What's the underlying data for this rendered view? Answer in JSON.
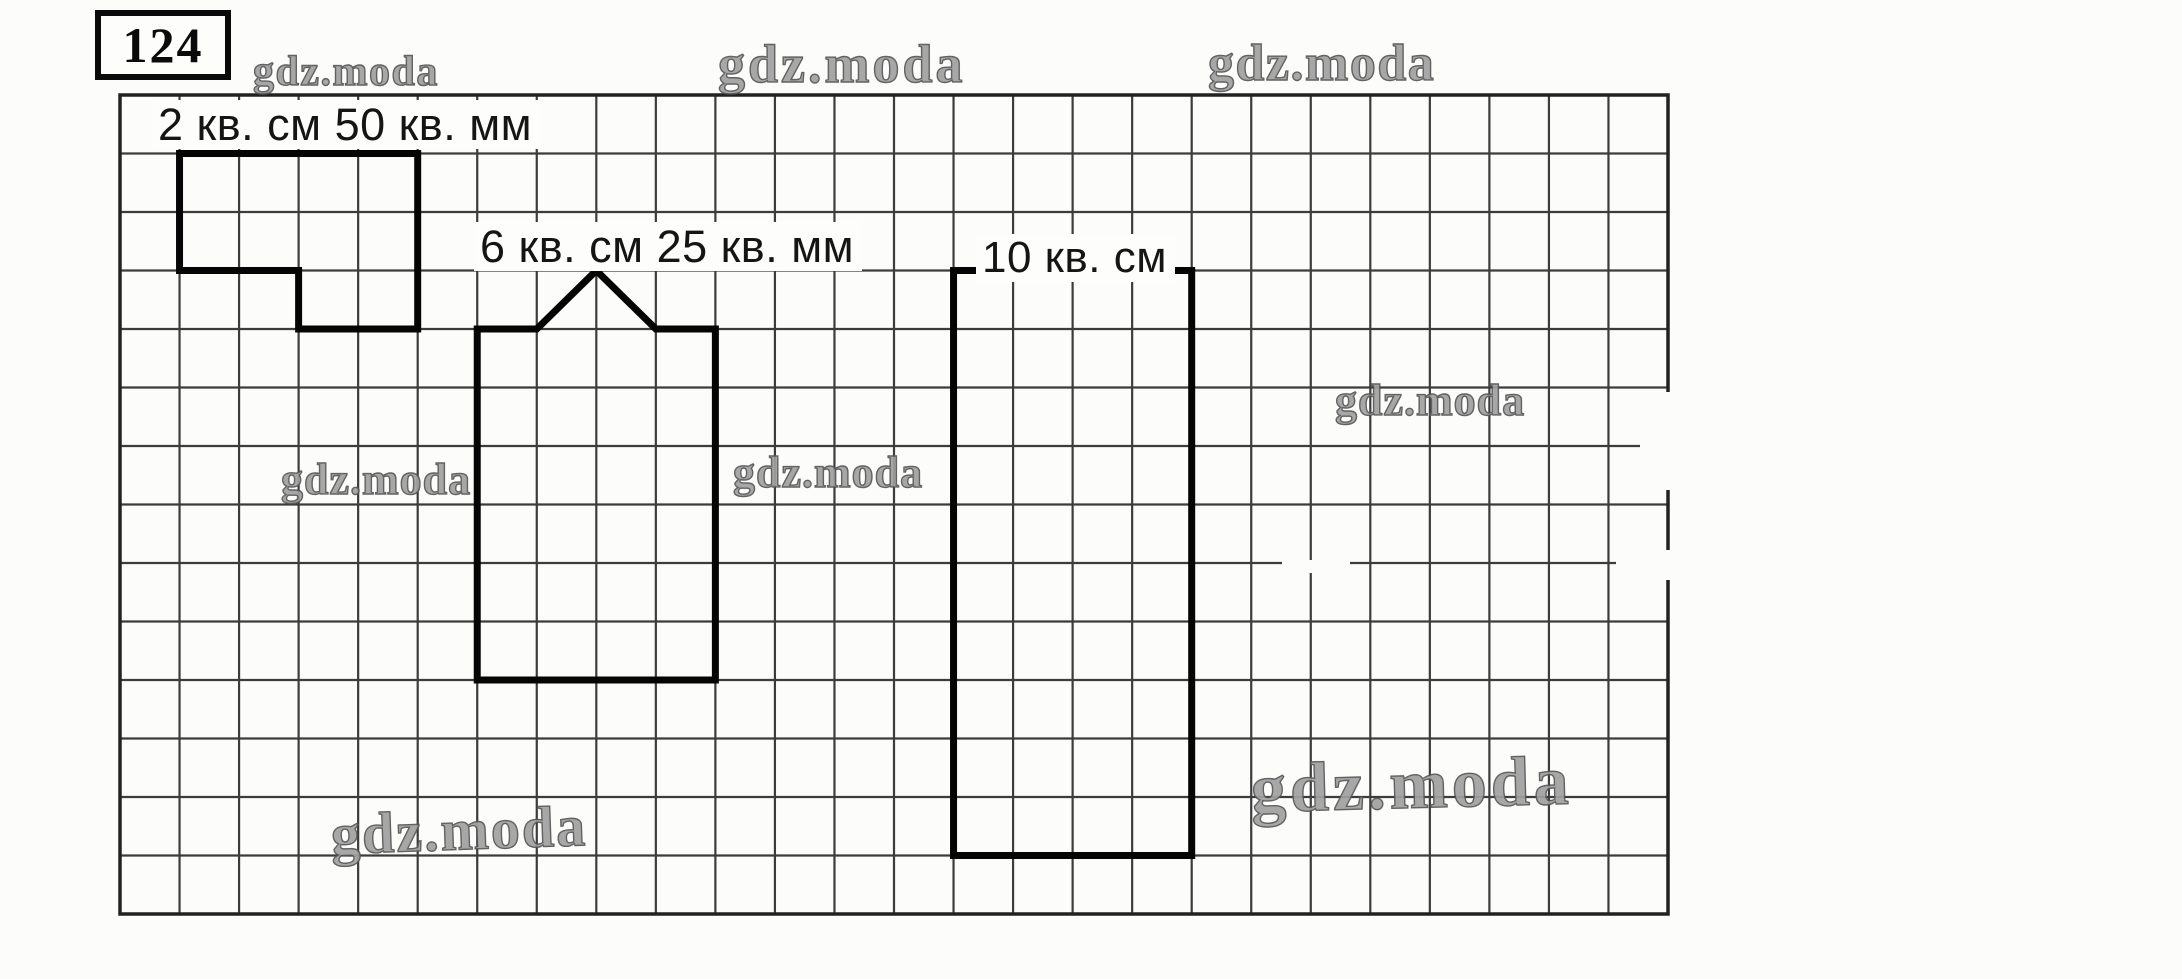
{
  "problem_number": "124",
  "watermark_text": "gdz.moda",
  "paper_color": "#fcfcfa",
  "grid": {
    "left": 120,
    "top": 95,
    "width": 1548,
    "height": 819,
    "cols": 26,
    "rows": 14,
    "line_color": "#3c3c3c",
    "border_color": "#222222",
    "line_width": 2.2,
    "border_width": 3.5
  },
  "shape_stroke": {
    "color": "#050505",
    "width": 7
  },
  "shapes": [
    {
      "name": "step-figure",
      "area_label": "2 кв. см 50 кв. мм",
      "label_pos": {
        "x": 152,
        "y": 100
      },
      "label_font_size": 45,
      "vertices_cells": [
        [
          1,
          1
        ],
        [
          5,
          1
        ],
        [
          5,
          4
        ],
        [
          3,
          4
        ],
        [
          3,
          3
        ],
        [
          1,
          3
        ]
      ]
    },
    {
      "name": "pentagon-house-figure",
      "area_label": "6 кв. см 25 кв. мм",
      "label_pos": {
        "x": 474,
        "y": 222
      },
      "label_font_size": 45,
      "vertices_cells": [
        [
          6,
          4
        ],
        [
          7,
          4
        ],
        [
          8,
          3
        ],
        [
          9,
          4
        ],
        [
          10,
          4
        ],
        [
          10,
          10
        ],
        [
          6,
          10
        ]
      ]
    },
    {
      "name": "tall-rectangle-figure",
      "area_label": "10 кв. см",
      "label_pos": {
        "x": 976,
        "y": 234
      },
      "label_font_size": 44,
      "vertices_cells": [
        [
          14,
          3
        ],
        [
          18,
          3
        ],
        [
          18,
          13
        ],
        [
          14,
          13
        ]
      ]
    }
  ],
  "watermarks": [
    {
      "x": 253,
      "y": 51,
      "font_size": 42,
      "letter_spacing": 1.5,
      "rotate": 0
    },
    {
      "x": 718,
      "y": 37,
      "font_size": 54,
      "letter_spacing": 3,
      "rotate": 0
    },
    {
      "x": 1208,
      "y": 38,
      "font_size": 52,
      "letter_spacing": 1.5,
      "rotate": 0
    },
    {
      "x": 1335,
      "y": 379,
      "font_size": 44,
      "letter_spacing": 1,
      "rotate": 0
    },
    {
      "x": 281,
      "y": 458,
      "font_size": 44,
      "letter_spacing": 1,
      "rotate": 0
    },
    {
      "x": 733,
      "y": 451,
      "font_size": 44,
      "letter_spacing": 1,
      "rotate": 0
    },
    {
      "x": 330,
      "y": 806,
      "font_size": 58,
      "letter_spacing": 2,
      "rotate": -2
    },
    {
      "x": 1250,
      "y": 755,
      "font_size": 70,
      "letter_spacing": 4,
      "rotate": -1.5
    }
  ],
  "white_patches": [
    {
      "x": 1640,
      "y": 392,
      "w": 38,
      "h": 98
    },
    {
      "x": 1616,
      "y": 550,
      "w": 56,
      "h": 30
    },
    {
      "x": 1282,
      "y": 560,
      "w": 68,
      "h": 13
    },
    {
      "x": 1320,
      "y": 541,
      "w": 36,
      "h": 18
    }
  ]
}
